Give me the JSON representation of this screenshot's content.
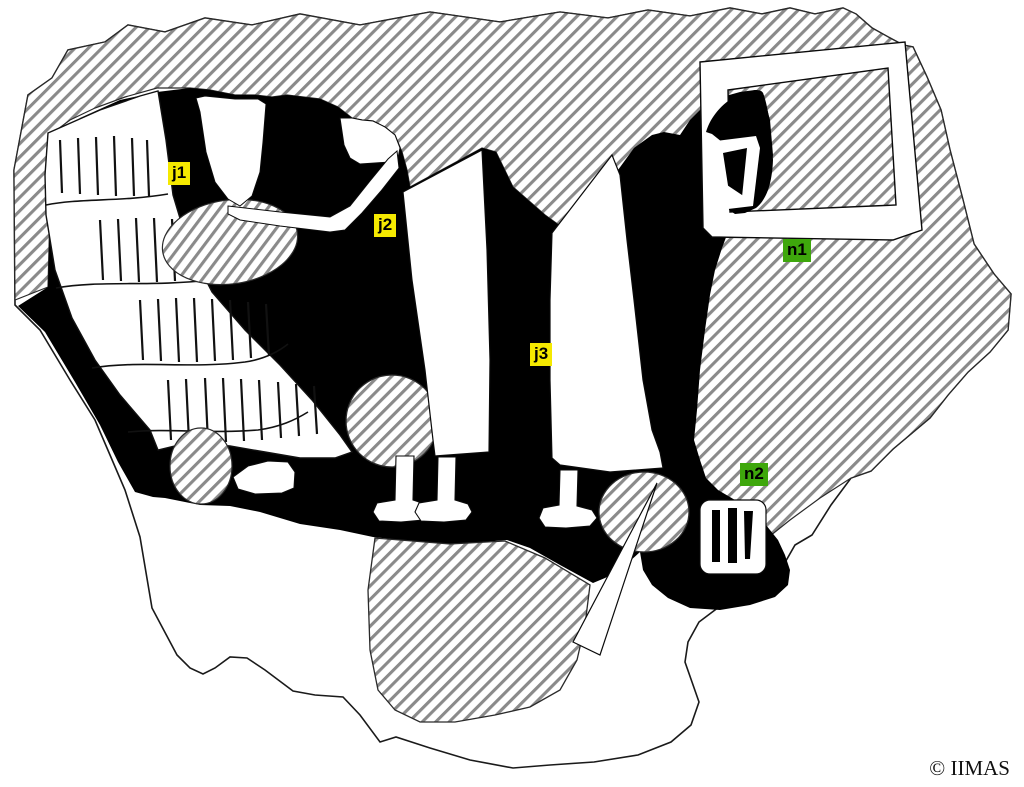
{
  "figure": {
    "description": "Line drawing of an ancient wall-painting fragment: black painted field with white robed figures (fringed garment, bare feet), hatched lacunae, framed panel at upper right",
    "labels": [
      {
        "id": "j1",
        "text": "j1",
        "bg": "#f5e900"
      },
      {
        "id": "j2",
        "text": "j2",
        "bg": "#f5e900"
      },
      {
        "id": "j3",
        "text": "j3",
        "bg": "#f5e900"
      },
      {
        "id": "n1",
        "text": "n1",
        "bg": "#3ea70c"
      },
      {
        "id": "n2",
        "text": "n2",
        "bg": "#3ea70c"
      }
    ],
    "credit": {
      "text": "© IIMAS"
    },
    "colors": {
      "paint_black": "#000000",
      "hatch_line": "#8a8a8a",
      "outline": "#1a1a1a",
      "label_yellow": "#f5e900",
      "label_green": "#3ea70c"
    }
  }
}
